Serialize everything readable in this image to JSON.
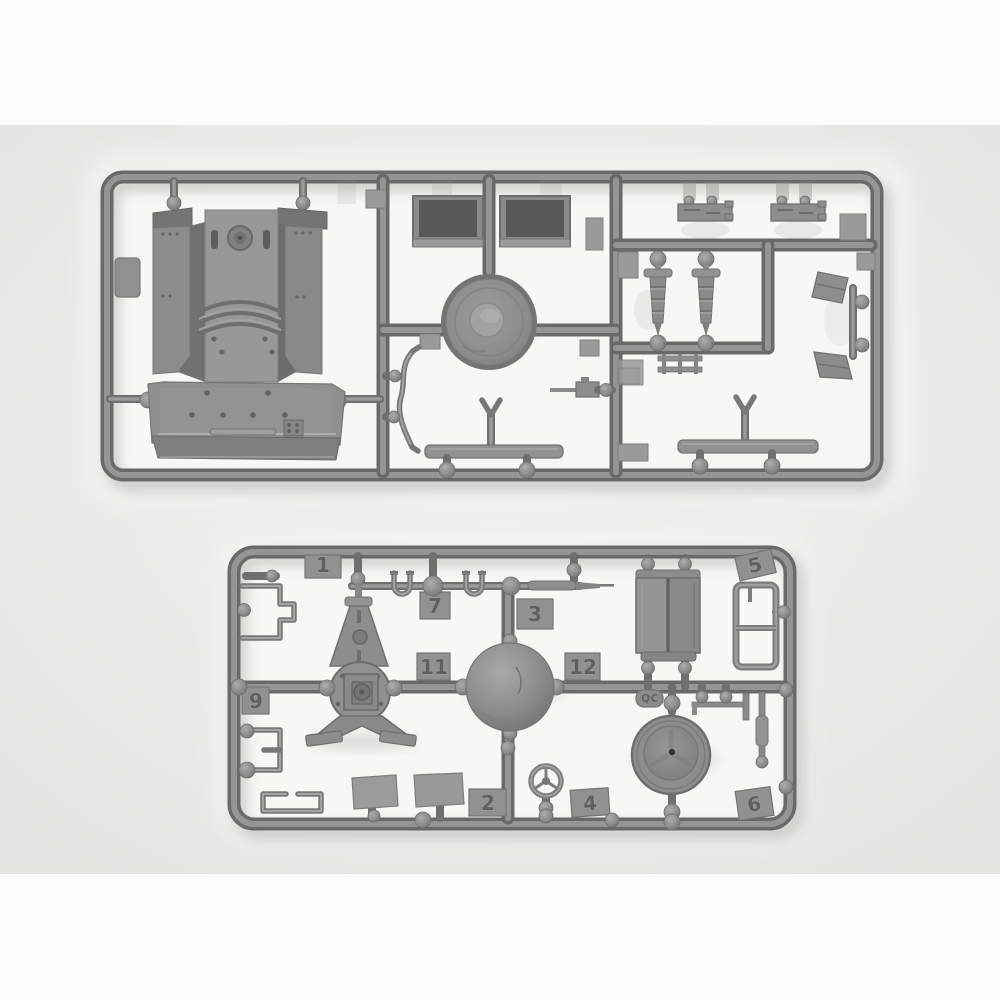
{
  "colors": {
    "letterbox": "#fcfcfc",
    "photo_background": "#eaeae9",
    "backing_paper": "#f8f8f6",
    "plastic_mid": "#8d8d8d",
    "plastic_dark": "#6a6a6a",
    "plastic_light": "#9e9e9e",
    "recess_dark": "#565656",
    "tab_face": "#919191",
    "molded_digit": "#5f5f5f"
  },
  "bottom_sprue": {
    "tabs": [
      {
        "label": "1"
      },
      {
        "label": "7"
      },
      {
        "label": "3"
      },
      {
        "label": "5"
      },
      {
        "label": "9"
      },
      {
        "label": "11"
      },
      {
        "label": "12"
      },
      {
        "label": "2"
      },
      {
        "label": "4"
      },
      {
        "label": "6"
      }
    ],
    "qc_stamp": {
      "label": "QC"
    }
  }
}
